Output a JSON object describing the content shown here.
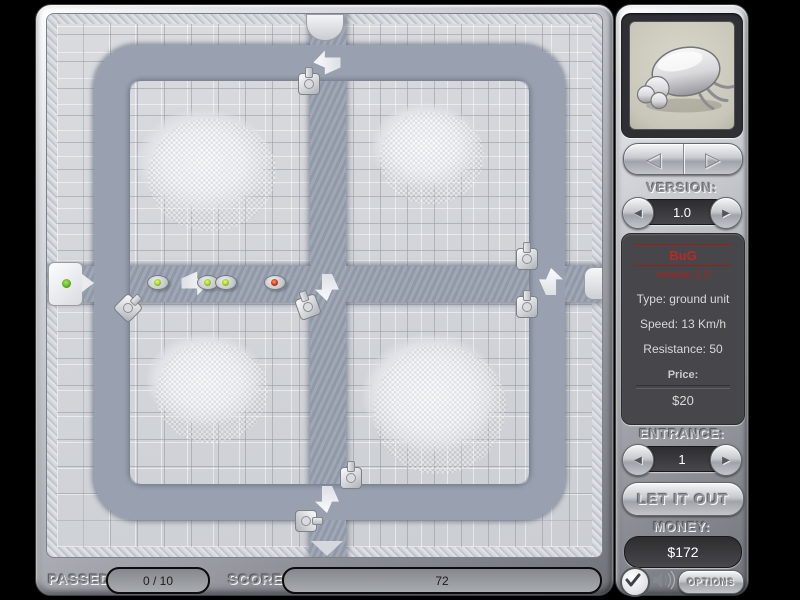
{
  "sidebar": {
    "version_label": "VERSION:",
    "version_value": "1.0",
    "unit": {
      "name": "BuG",
      "version": "version 1.0",
      "type": "Type: ground unit",
      "speed": "Speed: 13 Km/h",
      "resistance": "Resistance: 50",
      "price_label": "Price:",
      "price_value": "$20"
    },
    "entrance_label": "ENTRANCE:",
    "entrance_value": "1",
    "release_label": "LET IT OUT",
    "money_label": "MONEY:",
    "money_value": "$172",
    "options_label": "OPTIONS"
  },
  "statusbar": {
    "passed_label": "PASSED",
    "passed_value": "0 / 10",
    "score_label": "SCORE",
    "score_value": "72"
  },
  "icons": {
    "nav_prev": "◁",
    "nav_next": "▷",
    "spin_prev": "◀",
    "spin_next": "▶",
    "portrait": "beetle-image",
    "confirm": "check-icon",
    "sound": "speaker-icon"
  },
  "colors": {
    "unit_text_red": "#b92a20",
    "bug_dot_green": "#9ccc22",
    "bug_dot_red": "#cc3318",
    "path": "#99a1b0",
    "money_text": "#ffffff"
  },
  "map": {
    "bugs": [
      {
        "x": 110,
        "y": 268,
        "dot": "green"
      },
      {
        "x": 160,
        "y": 268,
        "dot": "green"
      },
      {
        "x": 178,
        "y": 268,
        "dot": "green"
      },
      {
        "x": 227,
        "y": 268,
        "dot": "red"
      }
    ],
    "turrets": [
      {
        "x": 261,
        "y": 69,
        "r": 0
      },
      {
        "x": 80,
        "y": 293,
        "r": 45
      },
      {
        "x": 260,
        "y": 292,
        "r": -20
      },
      {
        "x": 479,
        "y": 244,
        "r": 0
      },
      {
        "x": 479,
        "y": 292,
        "r": 0
      },
      {
        "x": 303,
        "y": 463,
        "r": 0
      },
      {
        "x": 258,
        "y": 506,
        "r": 90
      }
    ],
    "arrows": [
      {
        "x": 280,
        "y": 48,
        "dir": "left"
      },
      {
        "x": 148,
        "y": 269,
        "dir": "right"
      },
      {
        "x": 280,
        "y": 273,
        "dir": "down"
      },
      {
        "x": 504,
        "y": 267,
        "dir": "up"
      },
      {
        "x": 280,
        "y": 485,
        "dir": "down"
      }
    ]
  }
}
